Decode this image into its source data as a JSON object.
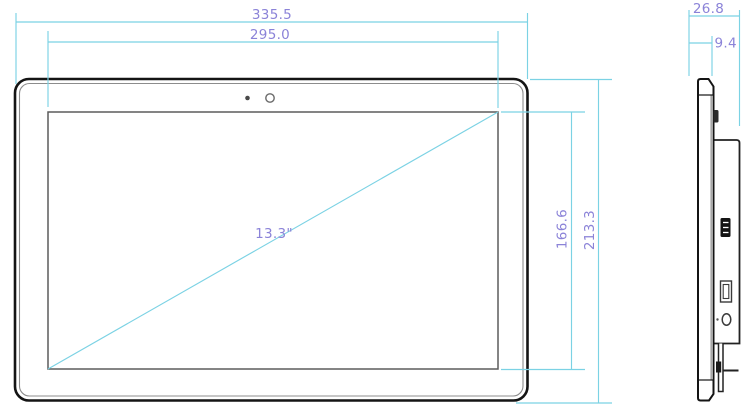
{
  "drawing": {
    "front_view": {
      "outer_width_mm": "335.5",
      "screen_width_mm": "295.0",
      "screen_height_mm": "166.6",
      "outer_height_mm": "213.3",
      "screen_diagonal": "13.3\""
    },
    "side_view": {
      "total_depth_mm": "26.8",
      "front_panel_depth_mm": "9.4"
    },
    "colors": {
      "dimension_line": "#7bd2e4",
      "dimension_text": "#8b83d8",
      "device_outline": "#141414"
    }
  }
}
